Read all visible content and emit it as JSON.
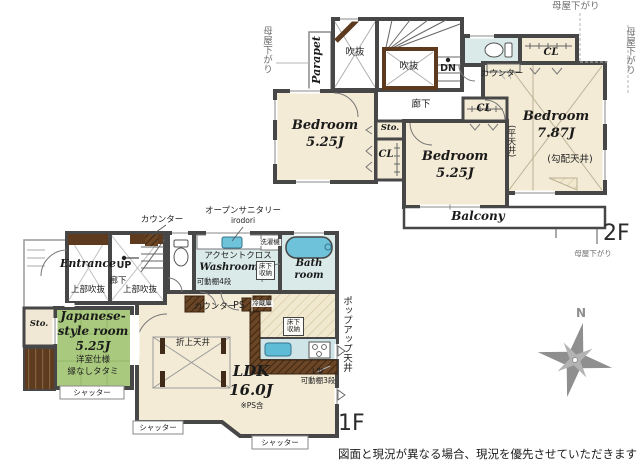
{
  "floor2": {
    "floor_label": "2F",
    "moya_left": "母屋下がり",
    "moya_top": "母屋下がり",
    "moya_right": "母屋下がり",
    "moya_bottom": "母屋下がり",
    "parapet": "Parapet",
    "void1": "吹抜",
    "void2": "吹抜",
    "dn": "DN",
    "hall": "廊下",
    "counter": "カウンター",
    "cl1": "CL",
    "cl2": "CL",
    "cl3": "CL",
    "sto": "Sto.",
    "bedroom1": {
      "name": "Bedroom",
      "size": "5.25J"
    },
    "bedroom2": {
      "name": "Bedroom",
      "size": "5.25J"
    },
    "bedroom3": {
      "name": "Bedroom",
      "size": "7.87J"
    },
    "flat_ceiling": "(平天井)",
    "sloped_ceiling": "(勾配天井)",
    "balcony": "Balcony"
  },
  "floor1": {
    "floor_label": "1F",
    "counter_top": "カウンター",
    "open_sanitary": "オープンサニタリー",
    "open_sanitary_sub": "irodori",
    "entrance": "Entrance",
    "up": "UP",
    "hall": "廊下",
    "void_above1": "上部吹抜",
    "void_above2": "上部吹抜",
    "accent_cloth": "アクセントクロス",
    "washroom": "Washroom",
    "washer": "洗濯機",
    "underfloor1_line1": "床下",
    "underfloor1_line2": "収納",
    "shelf4": "可動棚4段",
    "bath_line1": "Bath",
    "bath_line2": "room",
    "counter_mid": "カウンター",
    "ps": "PS",
    "fridge": "冷蔵庫",
    "underfloor2_line1": "床下",
    "underfloor2_line2": "収納",
    "popup_ceiling": "ポップアップ天井",
    "sto": "Sto.",
    "japanese": {
      "name1": "Japanese-",
      "name2": "style room",
      "size": "5.25J",
      "sub1": "洋室仕様",
      "sub2": "縁なしタタミ"
    },
    "coffered_ceiling": "折上天井",
    "ldk": {
      "name": "LDK",
      "size": "16.0J",
      "note": "※PS含"
    },
    "l_shelf_line1": "L型",
    "l_shelf_line2": "可動棚3段",
    "shutter1": "シャッター",
    "shutter2": "シャッター",
    "shutter3": "シャッター"
  },
  "compass": {
    "north": "N"
  },
  "disclaimer": "図面と現況が異なる場合、現況を優先させていただきます",
  "colors": {
    "wall": "#474747",
    "room_cream": "#f3ebd6",
    "tatami_green": "#a9ca7e",
    "wet_blue": "#d9eae8",
    "fixture_blue": "#6ec2da",
    "wood_brown": "#5e3a1e",
    "compass_gray": "#8f8f8f"
  }
}
